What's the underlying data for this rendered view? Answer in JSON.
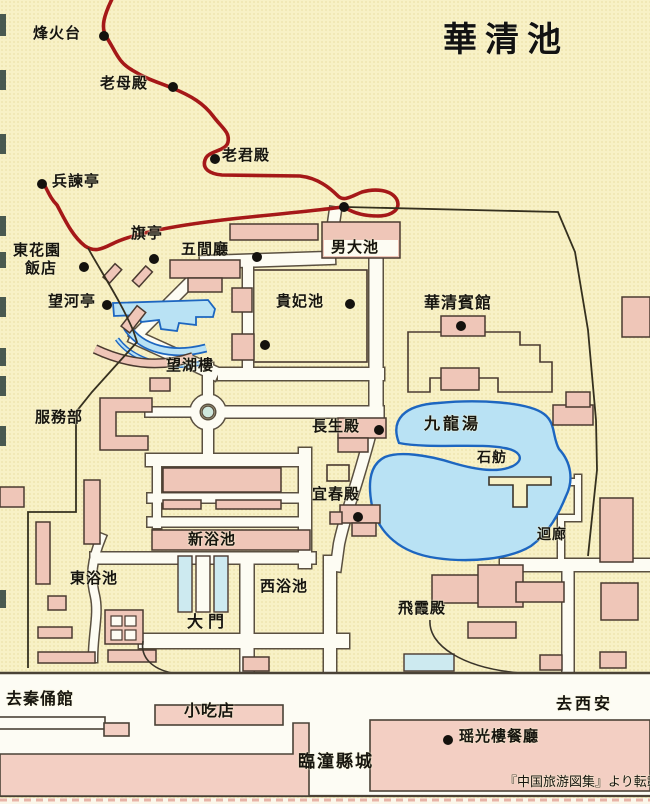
{
  "title": "華清池",
  "credit": "『中国旅游図集』より転載",
  "labels": {
    "fenghuotai": "烽火台",
    "laomudian": "老母殿",
    "laojundian": "老君殿",
    "bingjianting": "兵諫亭",
    "donghuayuan_line1": "東花園",
    "donghuayuan_line2": "飯店",
    "qiting": "旗亭",
    "wujianting": "五間廳",
    "nandachi": "男大池",
    "guifeichi": "貴妃池",
    "huaqing_hotel": "華清賓館",
    "wangheting": "望河亭",
    "wanghulou": "望湖樓",
    "fuwubu": "服務部",
    "changshengdian": "長生殿",
    "jiulongtang": "九龍湯",
    "shifang": "石舫",
    "yichundian": "宜春殿",
    "huilang": "迴廊",
    "xinyuchi": "新浴池",
    "dongyuchi": "東浴池",
    "xiyuchi": "西浴池",
    "damen": "大門",
    "feixiadian": "飛霞殿",
    "qu_qinyongguan": "去秦俑館",
    "xiaochidian": "小吃店",
    "qu_xian": "去西安",
    "yaoguanglou": "瑶光樓餐廳",
    "lintong": "臨潼縣城"
  },
  "colors": {
    "background": "#f8f1c6",
    "building_pink": "#efc6b8",
    "water_fill": "#b9e2f4",
    "water_outline": "#1d66c0",
    "road_fill": "#fdfcf3",
    "road_casing": "#5a5040",
    "mountain_road_red": "#a51818",
    "text": "#17150f"
  }
}
